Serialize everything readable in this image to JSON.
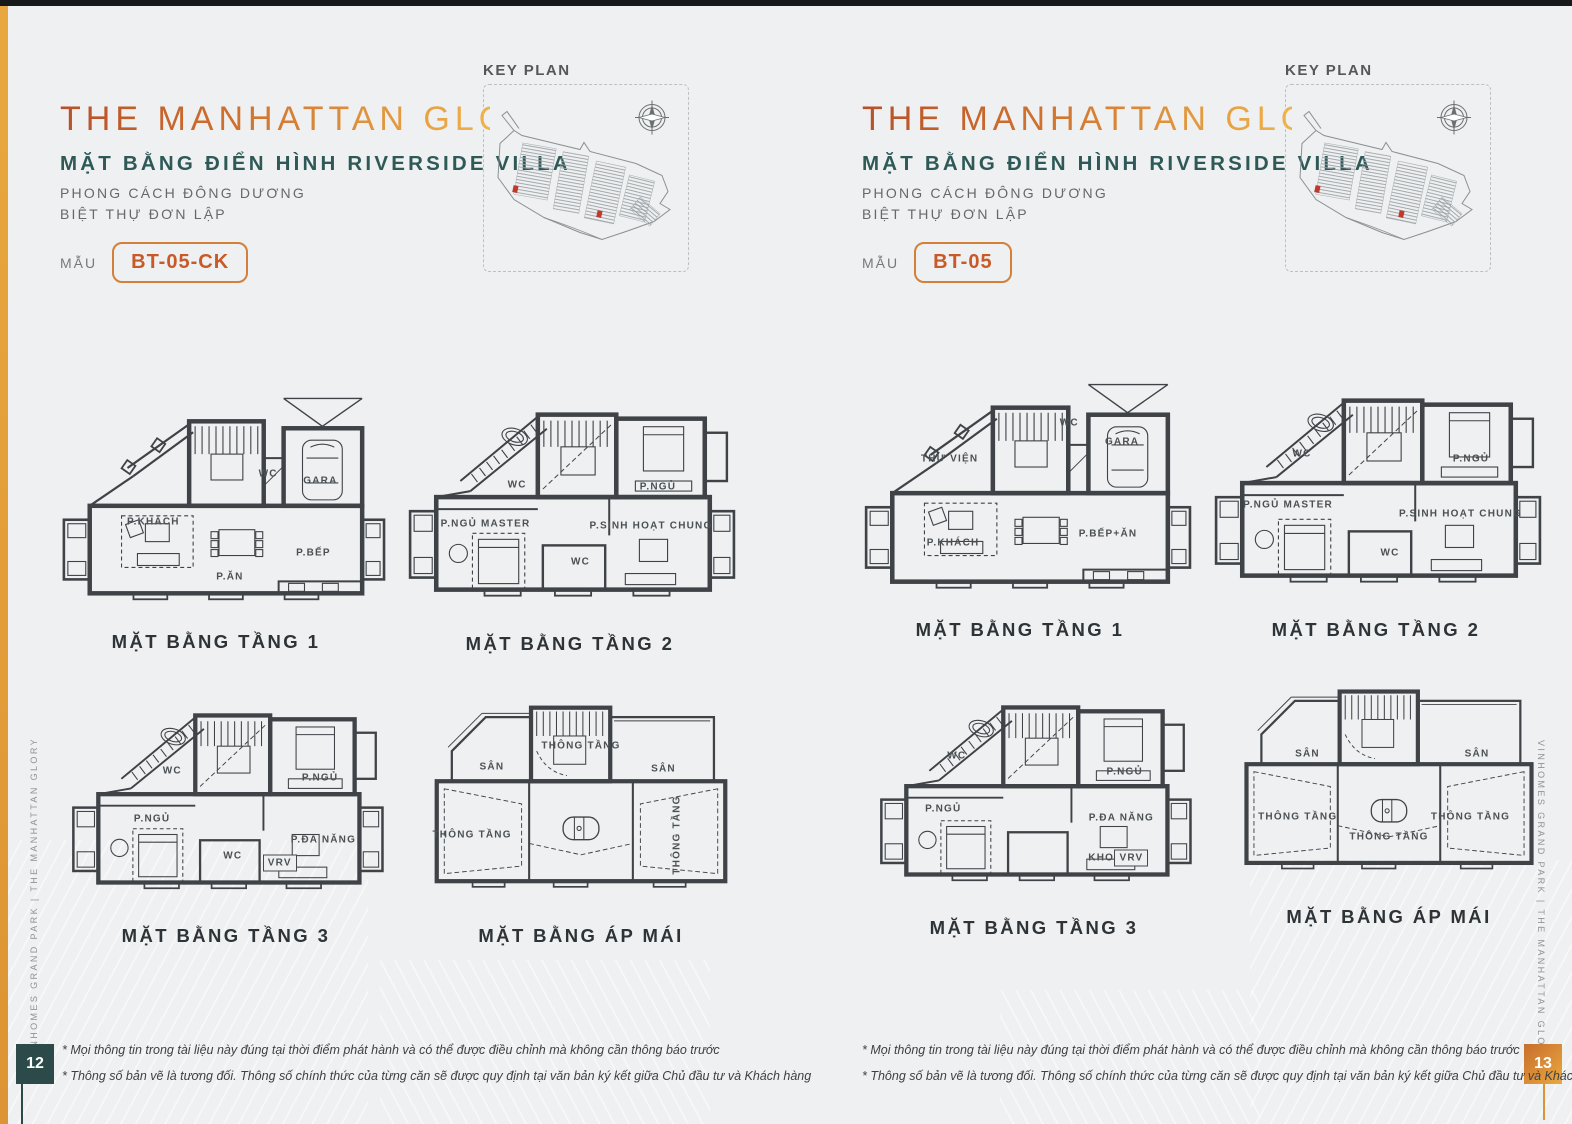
{
  "colors": {
    "accent_gold": "#e7a23f",
    "title_gradient_start": "#b65029",
    "title_gradient_end": "#efb24a",
    "teal": "#2e5957",
    "model_orange": "#c85a28",
    "plan_ink": "#3f4347",
    "marker_red": "#bf3a2b",
    "page_num_left_bg": "#2b4a49",
    "page_num_right_bg": "#dd8a35"
  },
  "left_page": {
    "title": "THE MANHATTAN GLORY",
    "subtitle": "MẶT BẰNG ĐIỂN HÌNH RIVERSIDE VILLA",
    "style_lines": [
      "PHONG CÁCH ĐÔNG DƯƠNG",
      "BIỆT THỰ ĐƠN LẬP"
    ],
    "model_label": "MẪU",
    "model_code": "BT-05-CK",
    "key_plan_title": "KEY PLAN",
    "page_number": "12",
    "side_text": "VINHOMES GRAND PARK  |  THE MANHATTAN GLORY",
    "footnotes": [
      "* Mọi thông tin trong tài liệu này đúng tại thời điểm phát hành và có thể được điều chỉnh mà không cần thông báo trước",
      "* Thông số bản vẽ là tương đối. Thông số chính thức của từng căn sẽ được quy định tại văn bản ký kết giữa Chủ đầu tư và Khách hàng"
    ],
    "plans": [
      {
        "caption": "MẶT BẰNG TẦNG 1",
        "rooms": [
          {
            "label": "P.KHÁCH",
            "x": 32,
            "y": 57
          },
          {
            "label": "P.ĂN",
            "x": 54,
            "y": 80
          },
          {
            "label": "WC",
            "x": 65,
            "y": 37
          },
          {
            "label": "GARA",
            "x": 80,
            "y": 40
          },
          {
            "label": "P.BẾP",
            "x": 78,
            "y": 70
          }
        ]
      },
      {
        "caption": "MẶT BẰNG TẦNG 2",
        "rooms": [
          {
            "label": "WC",
            "x": 35,
            "y": 41
          },
          {
            "label": "P.NGỦ",
            "x": 75,
            "y": 42
          },
          {
            "label": "P.NGỦ MASTER",
            "x": 26,
            "y": 57
          },
          {
            "label": "P.SINH HOẠT CHUNG",
            "x": 73,
            "y": 58
          },
          {
            "label": "WC",
            "x": 53,
            "y": 73
          }
        ]
      },
      {
        "caption": "MẶT BẰNG TẦNG 3",
        "rooms": [
          {
            "label": "WC",
            "x": 34,
            "y": 36
          },
          {
            "label": "P.NGỦ",
            "x": 78,
            "y": 39
          },
          {
            "label": "P.NGỦ",
            "x": 28,
            "y": 57
          },
          {
            "label": "WC",
            "x": 52,
            "y": 73
          },
          {
            "label": "P.ĐA NĂNG",
            "x": 79,
            "y": 66
          },
          {
            "label": "VRV",
            "x": 66,
            "y": 76,
            "box": true
          }
        ]
      },
      {
        "caption": "MẶT BẰNG ÁP MÁI",
        "rooms": [
          {
            "label": "SÂN",
            "x": 23,
            "y": 33
          },
          {
            "label": "THÔNG TẦNG",
            "x": 50,
            "y": 24
          },
          {
            "label": "SÂN",
            "x": 75,
            "y": 34
          },
          {
            "label": "THÔNG TẦNG",
            "x": 17,
            "y": 63
          },
          {
            "label": "THÔNG TẦNG",
            "x": 79,
            "y": 63,
            "rot": -90
          }
        ]
      }
    ]
  },
  "right_page": {
    "title": "THE MANHATTAN GLORY",
    "subtitle": "MẶT BẰNG ĐIỂN HÌNH RIVERSIDE VILLA",
    "style_lines": [
      "PHONG CÁCH ĐÔNG DƯƠNG",
      "BIỆT THỰ ĐƠN LẬP"
    ],
    "model_label": "MẪU",
    "model_code": "BT-05",
    "key_plan_title": "KEY PLAN",
    "page_number": "13",
    "side_text": "VINHOMES GRAND PARK  |  THE MANHATTAN GLORY",
    "footnotes": [
      "* Mọi thông tin trong tài liệu này đúng tại thời điểm phát hành và có thể được điều chỉnh mà không cần thông báo trước",
      "* Thông số bản vẽ là tương đối. Thông số chính thức của từng căn sẽ được quy định tại văn bản ký kết giữa Chủ đầu tư và Khách hàng"
    ],
    "plans": [
      {
        "caption": "MẶT BẰNG TẦNG 1",
        "rooms": [
          {
            "label": "THƯ VIỆN",
            "x": 30,
            "y": 36
          },
          {
            "label": "WC",
            "x": 64,
            "y": 21
          },
          {
            "label": "GARA",
            "x": 79,
            "y": 29
          },
          {
            "label": "P.KHÁCH",
            "x": 31,
            "y": 71
          },
          {
            "label": "P.BẾP+ĂN",
            "x": 75,
            "y": 67
          }
        ]
      },
      {
        "caption": "MẶT BẰNG TẦNG 2",
        "rooms": [
          {
            "label": "WC",
            "x": 29,
            "y": 34
          },
          {
            "label": "P.NGỦ",
            "x": 77,
            "y": 36
          },
          {
            "label": "P.NGỦ MASTER",
            "x": 25,
            "y": 55
          },
          {
            "label": "P.SINH HOẠT CHUNG",
            "x": 74,
            "y": 59
          },
          {
            "label": "WC",
            "x": 54,
            "y": 75
          }
        ]
      },
      {
        "caption": "MẶT BẰNG TẦNG 3",
        "rooms": [
          {
            "label": "WC",
            "x": 27,
            "y": 33
          },
          {
            "label": "P.NGỦ",
            "x": 77,
            "y": 40
          },
          {
            "label": "P.NGỦ",
            "x": 23,
            "y": 56
          },
          {
            "label": "P.ĐA NĂNG",
            "x": 76,
            "y": 60
          },
          {
            "label": "KHO",
            "x": 70,
            "y": 77
          },
          {
            "label": "VRV",
            "x": 79,
            "y": 77,
            "box": true
          }
        ]
      },
      {
        "caption": "MẶT BẰNG ÁP MÁI",
        "rooms": [
          {
            "label": "SÂN",
            "x": 25,
            "y": 35
          },
          {
            "label": "SÂN",
            "x": 77,
            "y": 35
          },
          {
            "label": "THÔNG TẦNG",
            "x": 22,
            "y": 63
          },
          {
            "label": "THÔNG TẦNG",
            "x": 75,
            "y": 63
          },
          {
            "label": "THÔNG TẦNG",
            "x": 50,
            "y": 72
          }
        ]
      }
    ]
  }
}
